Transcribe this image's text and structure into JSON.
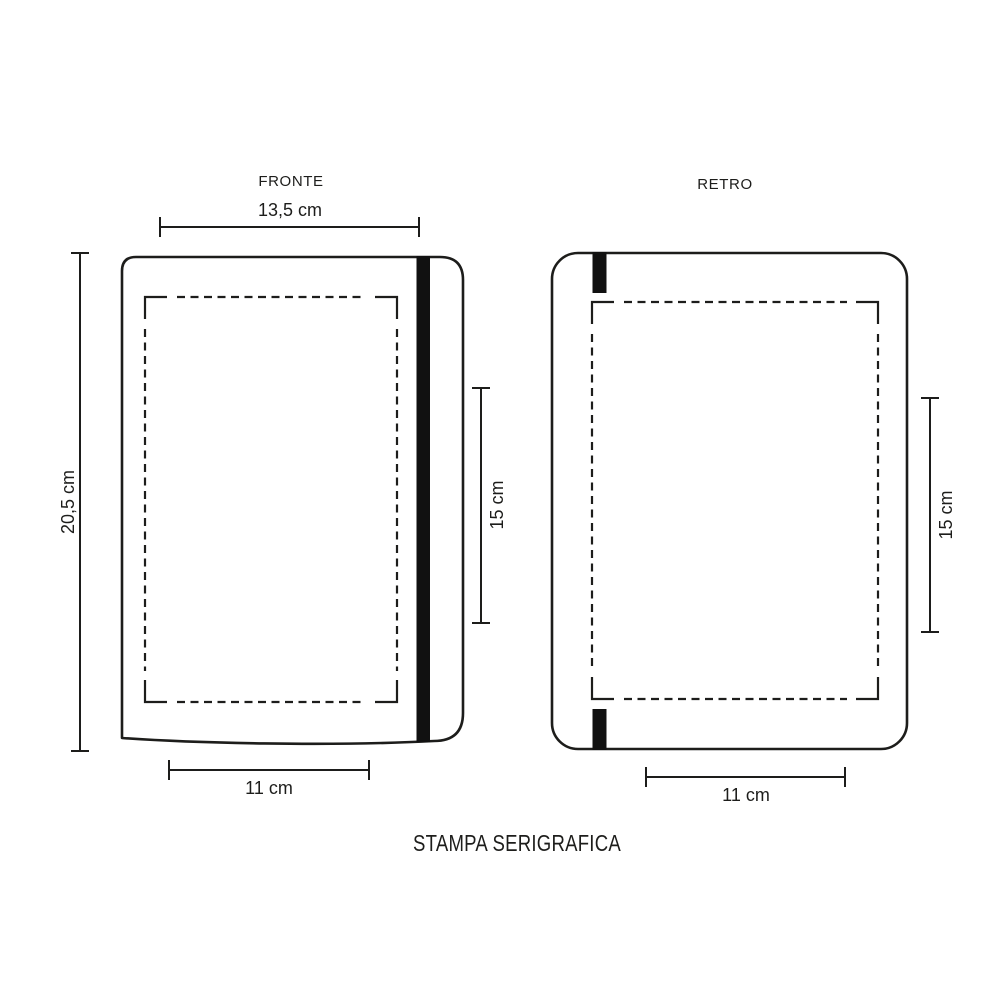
{
  "title": "STAMPA SERIGRAFICA",
  "front": {
    "label": "FRONTE",
    "cover_width": "13,5 cm",
    "cover_height": "20,5 cm",
    "print_height": "15 cm",
    "print_width": "11 cm"
  },
  "back": {
    "label": "RETRO",
    "print_height": "15 cm",
    "print_width": "11 cm"
  },
  "colors": {
    "line": "#1d1d1b",
    "band": "#111111",
    "background": "#ffffff"
  }
}
